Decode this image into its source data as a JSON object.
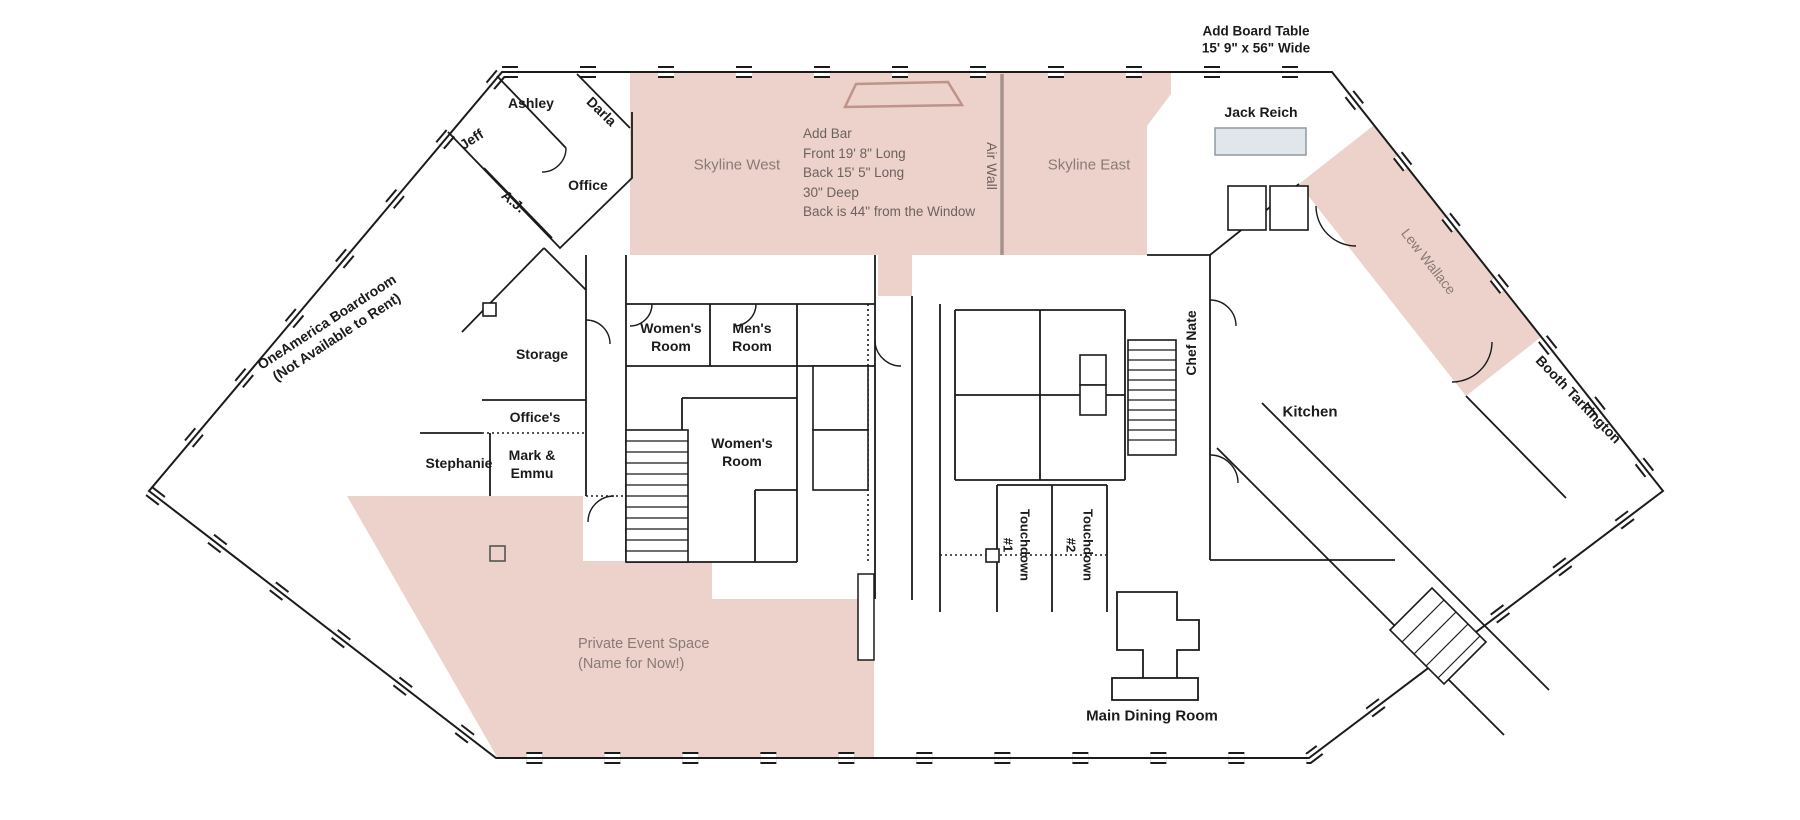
{
  "annotations": {
    "board_table": {
      "line1": "Add Board Table",
      "line2": "15' 9\" x 56\" Wide"
    },
    "bar_note": {
      "lines": [
        "Add Bar",
        "Front 19' 8\" Long",
        "Back 15' 5\" Long",
        "30\" Deep",
        "Back is 44\" from the Window"
      ]
    }
  },
  "rooms": {
    "skyline_west": "Skyline West",
    "skyline_east": "Skyline East",
    "air_wall": "Air Wall",
    "jack_reich": "Jack Reich",
    "lew_wallace": "Lew Wallace",
    "booth_tarkington": "Booth Tarkington",
    "kitchen": "Kitchen",
    "chef_nate": "Chef Nate",
    "touchdown_1": {
      "name": "Touchdown",
      "number": "#1"
    },
    "touchdown_2": {
      "name": "Touchdown",
      "number": "#2"
    },
    "main_dining": "Main Dining Room",
    "private_event": {
      "line1": "Private Event Space",
      "line2": "(Name for Now!)"
    },
    "boardroom": {
      "line1": "OneAmerica Boardroom",
      "line2": "(Not Available to Rent)"
    },
    "storage": "Storage",
    "offices": "Office's",
    "office": "Office",
    "stephanie": "Stephanie",
    "mark_emmu": {
      "line1": "Mark &",
      "line2": "Emmu"
    },
    "ashley": "Ashley",
    "jeff": "Jeff",
    "darla": "Darla",
    "aj": "A.J.",
    "womens_room_upper": {
      "line1": "Women's",
      "line2": "Room"
    },
    "mens_room": {
      "line1": "Men's",
      "line2": "Room"
    },
    "womens_room_lower": {
      "line1": "Women's",
      "line2": "Room"
    }
  },
  "colors": {
    "highlight_fill": "#ecd2cb",
    "highlight_line": "#bd938a",
    "air_wall_line": "#a5928e",
    "table_fill": "#e1e6ea",
    "muted_text": "#8a7a76",
    "note_text": "#6d615d",
    "wall": "#1b1b1b"
  }
}
